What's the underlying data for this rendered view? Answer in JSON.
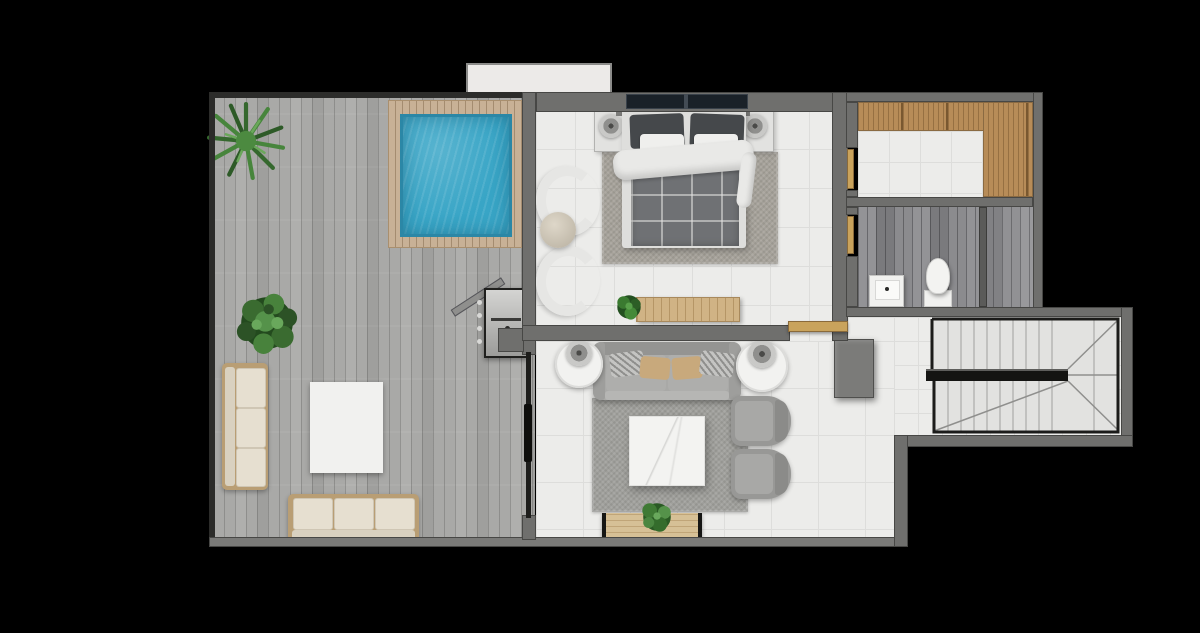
{
  "scene": {
    "type": "architectural-floor-plan-render",
    "view": "top-down-3d-render",
    "background_color": "#000000",
    "palette": {
      "wall": "#6f6f6d",
      "wall_dark": "#2c2c2a",
      "tile_floor": "#ececea",
      "tile_line": "#dddddb",
      "terrace_plank": "#a9a9a7",
      "pool_water": "#38a5c6",
      "pool_deck_wood": "#c8b196",
      "wardrobe_wood": "#b78c58",
      "door_wood_accent": "#c9a35c",
      "bathroom_plank": "#8b8b8e",
      "sofa_gray": "#a9a9a7",
      "outdoor_cream": "#e6dfd0",
      "plant_green": "#3f7a36",
      "plaid_blanket": "#6f7174",
      "marble_white": "#f3f3f1",
      "stair_rail": "#1c1c1c"
    },
    "rooms": [
      {
        "name": "terrace",
        "floor": "gray-wood-planks",
        "features": [
          "plunge-pool",
          "wood-pool-deck",
          "spiky-plant",
          "leafy-plant",
          "outdoor-sofa-left",
          "outdoor-sofa-bottom",
          "white-mat",
          "bbq-grill",
          "leaning-board"
        ]
      },
      {
        "name": "bedroom",
        "floor": "white-tile",
        "features": [
          "double-bed",
          "headboard-window",
          "dark-pillows",
          "white-pillows",
          "white-duvet",
          "plaid-blanket",
          "nightstand-left",
          "nightstand-right",
          "table-lamps",
          "area-rug",
          "curved-armchair-pair",
          "round-pouf",
          "wood-console",
          "console-plant"
        ]
      },
      {
        "name": "living-room",
        "floor": "white-tile",
        "features": [
          "gray-sofa",
          "throw-pillows",
          "round-marble-side-tables",
          "table-lamps",
          "area-rug",
          "marble-coffee-table",
          "gray-armchair-pair",
          "wood-media-bench",
          "bench-plant",
          "gray-cabinet",
          "sliding-glass-door",
          "open-wood-door"
        ]
      },
      {
        "name": "walk-in-closet",
        "floor": "white-tile",
        "features": [
          "l-shaped-wood-wardrobe",
          "open-wood-door"
        ]
      },
      {
        "name": "bathroom",
        "floor": "dark-wood-look-tile",
        "features": [
          "square-sink",
          "toilet",
          "shower-partition",
          "open-wood-door"
        ]
      },
      {
        "name": "stair-hall",
        "floor": "white-tile",
        "features": [
          "u-shaped-staircase",
          "stair-landing-rail",
          "winder-treads"
        ]
      }
    ],
    "exterior": {
      "features": [
        "balcony-slab"
      ]
    }
  }
}
